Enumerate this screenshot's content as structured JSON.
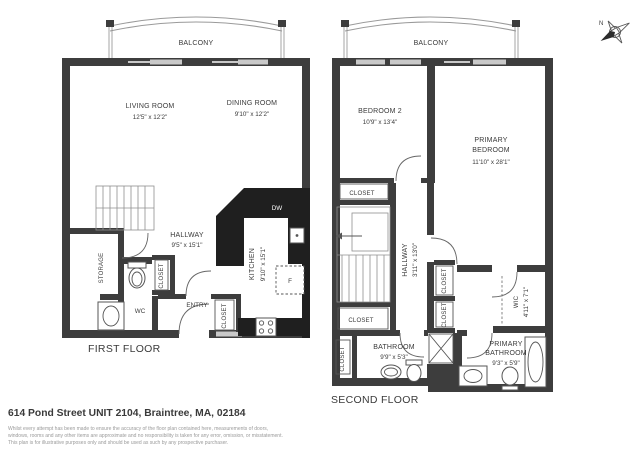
{
  "first_floor": {
    "title": "FIRST FLOOR",
    "balcony": "BALCONY",
    "living_room": {
      "name": "LIVING ROOM",
      "dims": "12'5\" x 12'2\""
    },
    "dining_room": {
      "name": "DINING ROOM",
      "dims": "9'10\" x 12'2\""
    },
    "hallway": {
      "name": "HALLWAY",
      "dims": "9'5\" x 15'1\""
    },
    "kitchen": {
      "name": "KITCHEN",
      "dims": "9'10\" x 15'1\""
    },
    "storage": "STORAGE",
    "wc": "WC",
    "entry": "ENTRY",
    "closet_hall": "CLOSET",
    "closet_entry": "CLOSET",
    "dishwasher": "DW",
    "fridge": "F"
  },
  "second_floor": {
    "title": "SECOND FLOOR",
    "balcony": "BALCONY",
    "bedroom2": {
      "name": "BEDROOM 2",
      "dims": "10'9\" x 13'4\""
    },
    "primary_bedroom": {
      "name_line1": "PRIMARY",
      "name_line2": "BEDROOM",
      "dims": "11'10\" x 28'1\""
    },
    "hallway": {
      "name": "HALLWAY",
      "dims": "3'11\" x 13'0\""
    },
    "bathroom": {
      "name": "BATHROOM",
      "dims": "9'9\" x 5'3\""
    },
    "primary_bathroom": {
      "name_line1": "PRIMARY",
      "name_line2": "BATHROOM",
      "dims": "9'3\" x 5'9\""
    },
    "wic": {
      "name": "WIC",
      "dims": "4'11\" x 7'1\""
    },
    "closet_bedroom2": "CLOSET",
    "closet_mid": "CLOSET",
    "closet_left": "CLOSET",
    "closet_hall_1": "CLOSET",
    "closet_hall_2": "CLOSET"
  },
  "compass": {
    "north": "N"
  },
  "footer": {
    "address": "614 Pond Street UNIT 2104, Braintree, MA, 02184",
    "disclaimer": [
      "Whilst every attempt has been made to ensure the accuracy of the floor plan contained here, measurements of doors,",
      "windows, rooms and any other items are approximate and no responsibility is taken for any error, omission, or misstatement.",
      "This plan is for illustrative purposes only and should be used as such by any prospective purchaser."
    ]
  },
  "colors": {
    "wall": "#3d3d3d",
    "counter": "#1f1f1f",
    "window": "#c9c9c9",
    "fixture_line": "#555555",
    "text": "#3a3a3a",
    "muted_text": "#9a9a9a"
  }
}
